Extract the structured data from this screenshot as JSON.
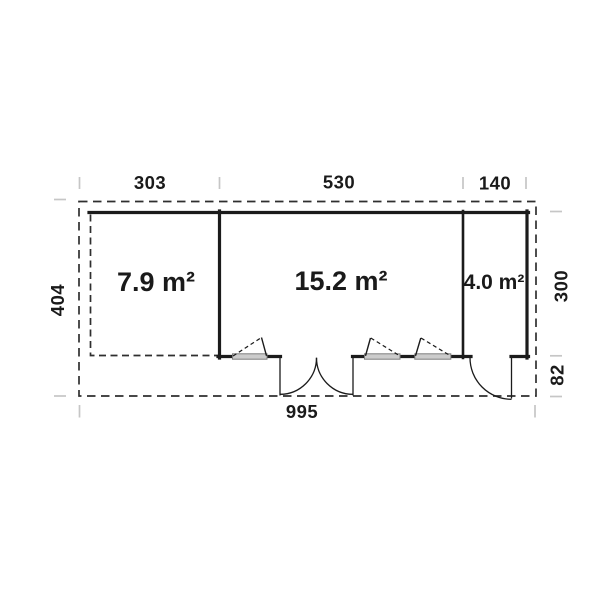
{
  "plan": {
    "type": "floorplan",
    "rooms": [
      {
        "name": "terrace",
        "area": "7.9 m²"
      },
      {
        "name": "main-room",
        "area": "15.2 m²"
      },
      {
        "name": "annex-room",
        "area": "4.0 m²"
      }
    ],
    "dimensions": {
      "top": [
        "303",
        "530",
        "140"
      ],
      "bottom": "995",
      "left": "404",
      "right_upper": "300",
      "right_lower": "82"
    },
    "colors": {
      "wall": "#1b1b1b",
      "dashed_outline": "#2f2f2f",
      "tick": "#c6c6c6",
      "window_fill": "#cccccc",
      "window_border": "#7d7d7d",
      "text": "#1a1a1a",
      "background": "#ffffff"
    }
  }
}
